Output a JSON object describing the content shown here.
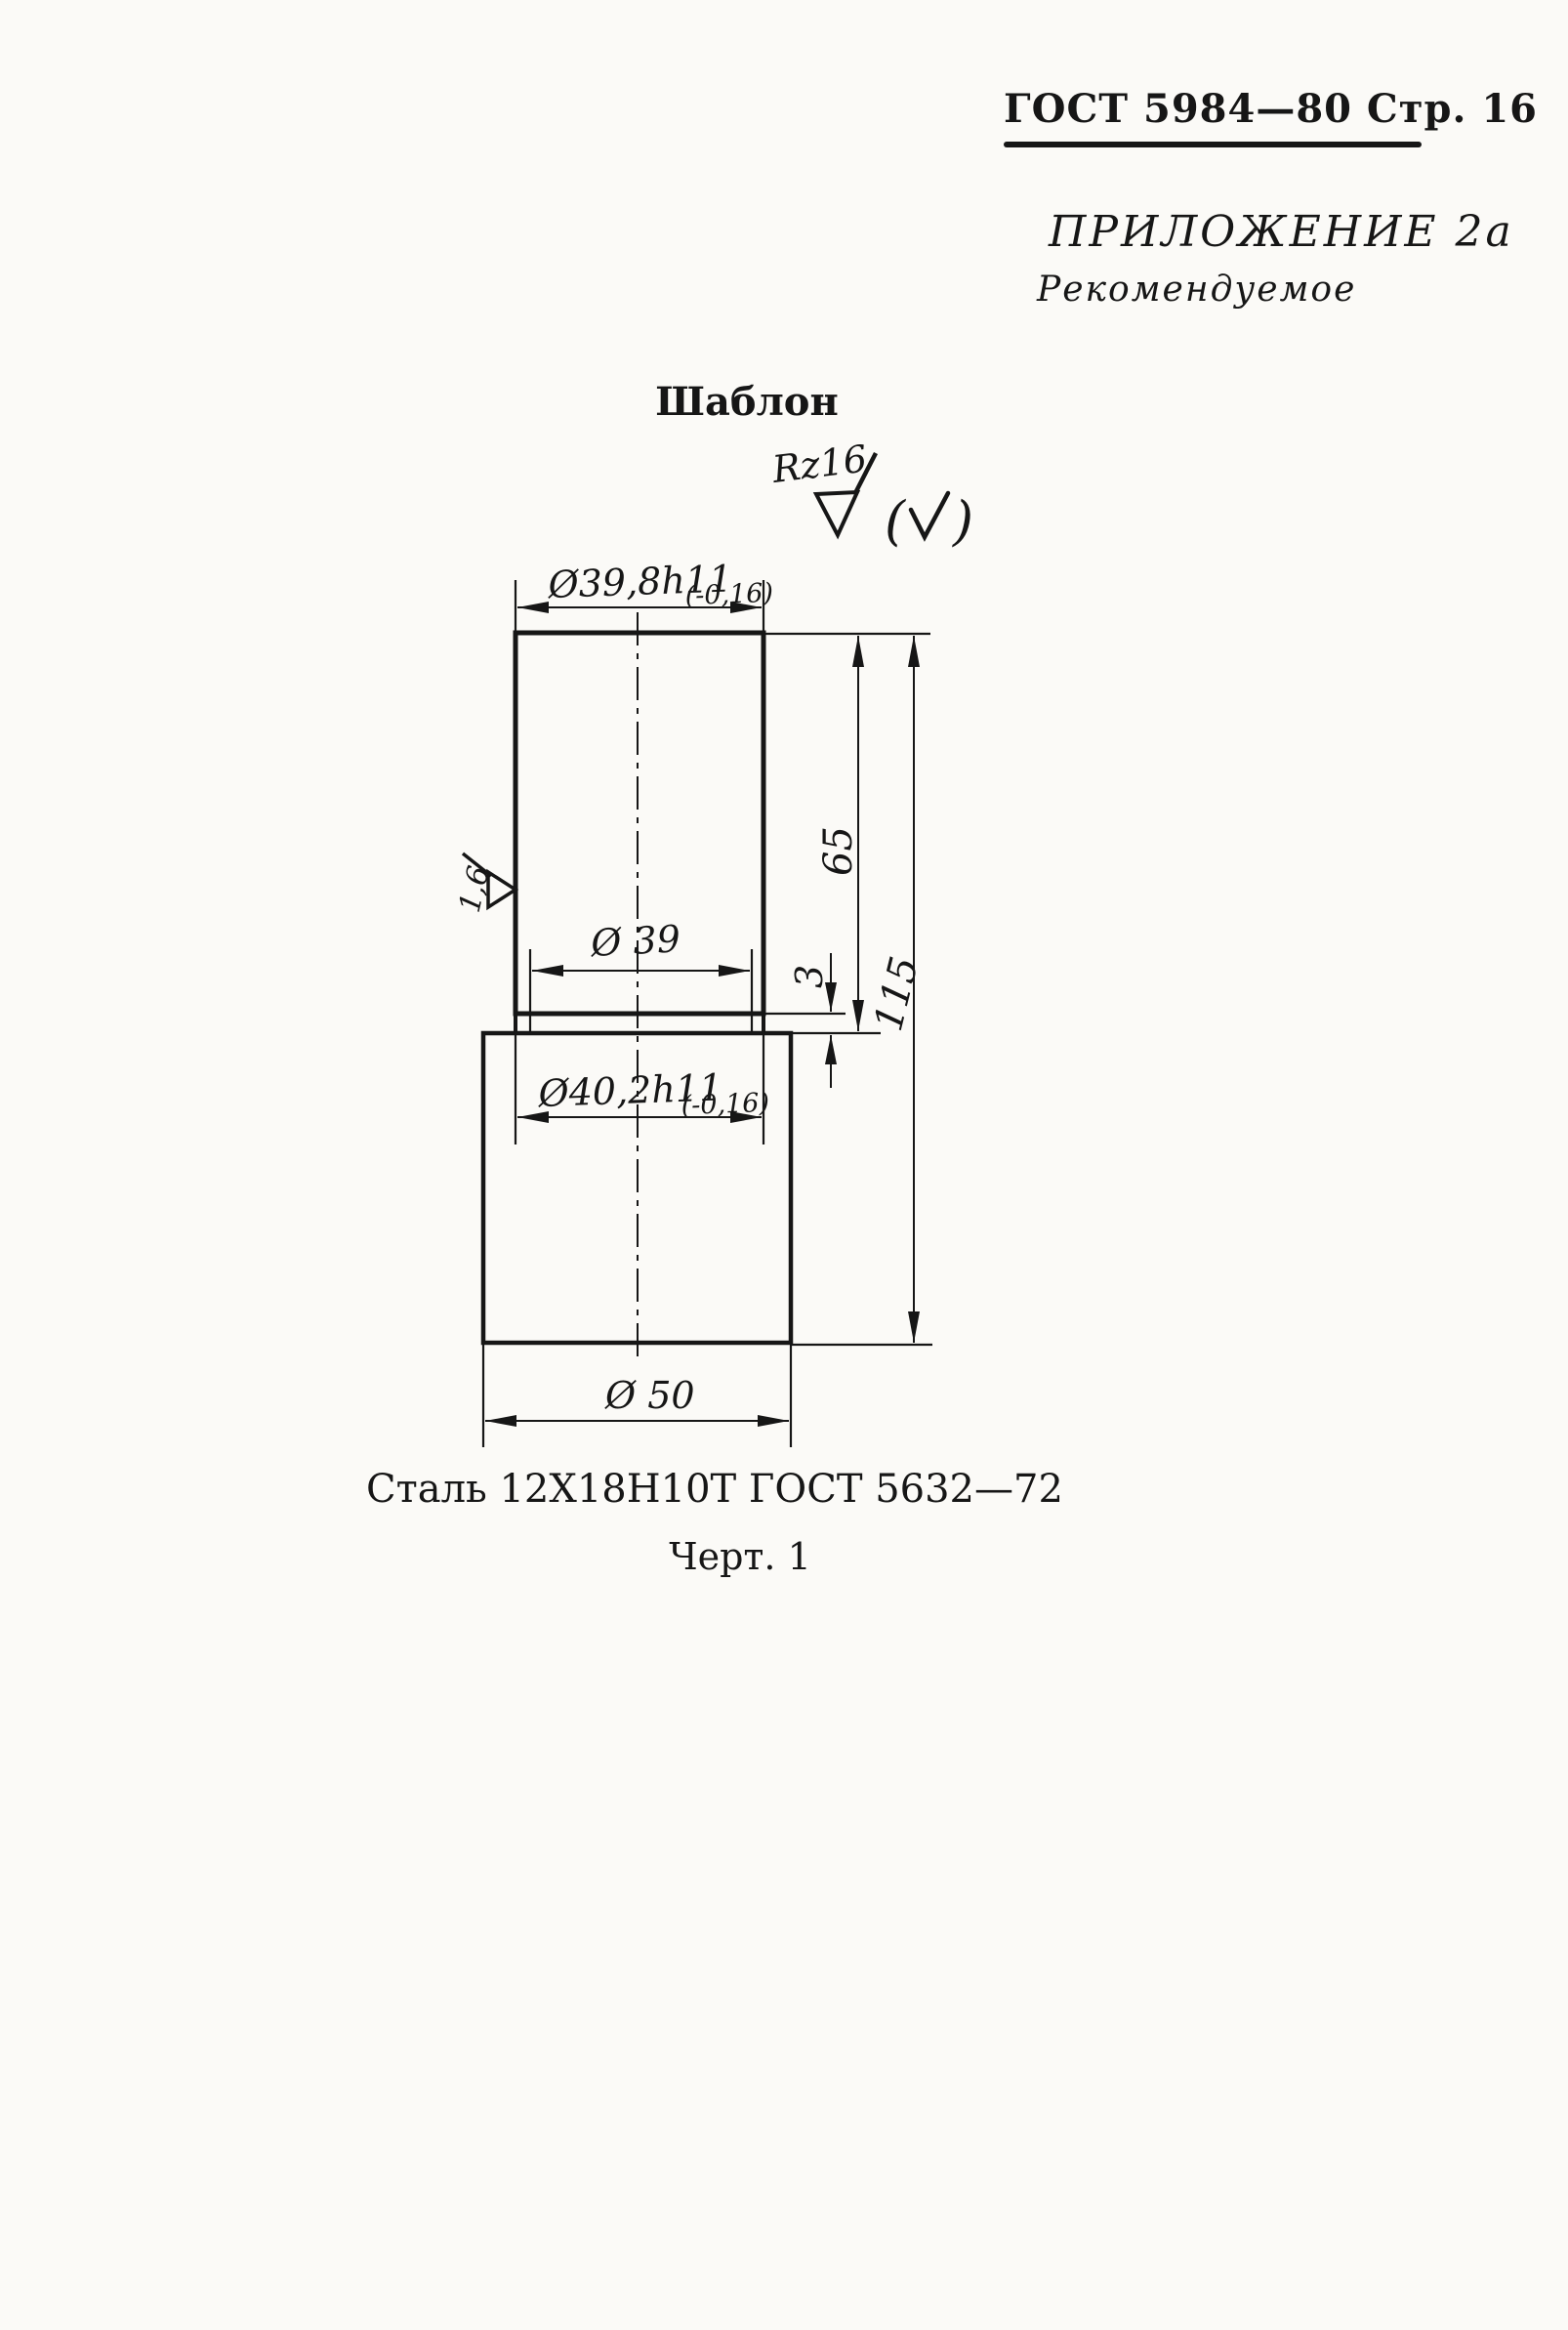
{
  "page": {
    "header": "ГОСТ 5984—80 Стр. 16",
    "appendix": "ПРИЛОЖЕНИЕ 2а",
    "appendix_note": "Рекомендуемое",
    "drawing_title": "Шаблон",
    "material": "Сталь 12Х18Н10Т ГОСТ 5632—72",
    "figure_caption": "Черт. 1"
  },
  "drawing": {
    "roughness_top_value": "Rz16",
    "roughness_side_value": "1,6",
    "paren_open": "(",
    "paren_close": ")",
    "dims": {
      "top_diameter": "Ø39,8h11",
      "top_tolerance": "(-0,16)",
      "bore_diameter": "Ø 39",
      "collar_diameter": "Ø40,2h11",
      "collar_tolerance": "(-0,16)",
      "base_diameter": "Ø 50",
      "upper_height": "65",
      "total_height": "115",
      "step_height": "3"
    }
  },
  "colors": {
    "ink": "#161616",
    "paper": "#fbfaf7"
  }
}
